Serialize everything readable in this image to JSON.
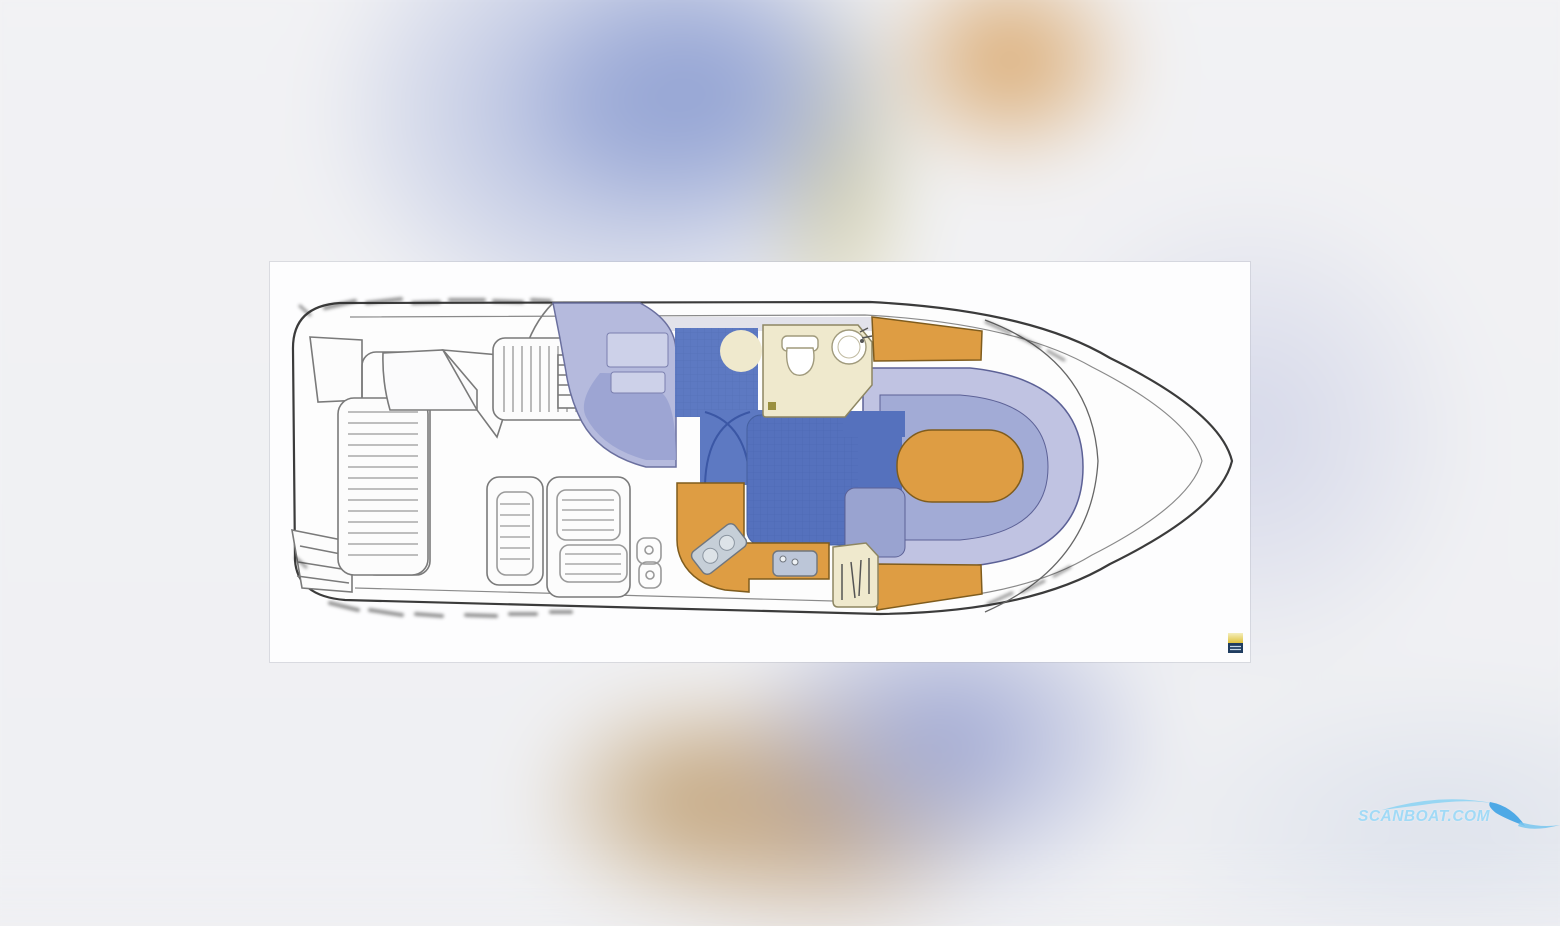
{
  "watermark": {
    "text": "SCANBOAT.COM"
  },
  "panel": {
    "brand_mark_colors": {
      "top": "#e6cd4a",
      "bottom": "#203d60"
    }
  },
  "floorplan": {
    "type": "motor-yacht-deck-plan",
    "areas": [
      "swim-platform",
      "cockpit",
      "helm-console",
      "windscreen",
      "engine-hatch-sunpad",
      "aft-bench",
      "cockpit-benches",
      "boarding-steps",
      "companionway",
      "galley-counter",
      "stove",
      "galley-sink",
      "head-compartment",
      "toilet",
      "washbasin",
      "wardrobe-locker",
      "mid-cabin-berth",
      "bow-settee",
      "bow-table",
      "forward-berth-port",
      "forward-berth-starboard"
    ],
    "palette": {
      "floor_blue": "#5571bd",
      "upholstery_periwinkle": "#a2abd6",
      "companionway_periwinkle": "#b5badd",
      "wood_orange": "#de9d43",
      "head_cream": "#efe9cd",
      "hull_line": "#3b3b3b"
    }
  },
  "background": {
    "blobs": [
      "periwinkle-top",
      "olive-top",
      "orange-top",
      "lavender-right",
      "periwinkle-bottom-right",
      "tan-bottom"
    ]
  }
}
